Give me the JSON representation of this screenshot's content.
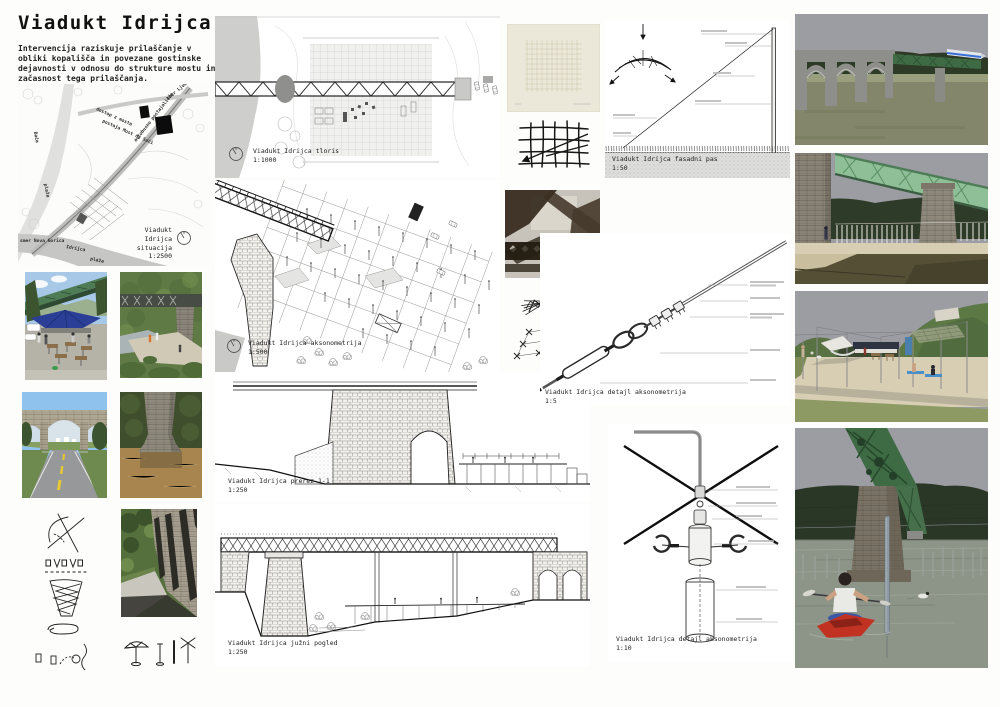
{
  "palette": {
    "truss_green_dark": "#3e6b44",
    "truss_green": "#4e7d55",
    "truss_green_light": "#8fbf96",
    "kayak_red": "#c23222",
    "sky_grey": "#9c9ca3",
    "sky_blue": "#a8c8e8",
    "hill_dark": "#2d3a26",
    "hill_green": "#5b7845",
    "sand": "#d7ceb4",
    "water_grey": "#8d9488",
    "mud_brown": "#a8854e",
    "umbrella_blue": "#2b3f96",
    "towel_blue": "#4a90c8",
    "paper_cream": "#ece8d9"
  },
  "header": {
    "title": "Viadukt Idrijca",
    "intro": "Intervencija raziskuje prilaščanje v obliki kopališča in povezane gostinske dejavnosti v odnosu do strukture mostu in začasnost tega prilaščanja."
  },
  "site_plan": {
    "label": "Viadukt Idrijca\nsituacija\n1:2500",
    "ann_access": "dostop z mosta",
    "ann_station": "postaja Most na Soči",
    "ann_bus": "avtobusno postajališče",
    "ann_beach": "plaža",
    "ann_beach2": "plaža",
    "ann_river_baca": "Bača",
    "ann_river_idrijca": "Idrijca",
    "ann_dir_ng": "smer Nova Gorica",
    "ann_dir_lj": "smer Ljubljana"
  },
  "labels": {
    "tloris": "Viadukt Idrijca tloris\n1:1000",
    "aksonometrija": "Viadukt Idrijca aksonometrija\n1:500",
    "prerez": "Viadukt Idrijca prerez 1-1\n1:250",
    "pogled": "Viadukt Idrijca južni pogled\n1:250",
    "fasadni_pas": "Viadukt Idrijca fasadni pas\n1:50",
    "detajl_5": "Viadukt Idrijca detajl aksonometrija\n1:5",
    "detajl_10": "Viadukt Idrijca detajl aksonometrija\n1:10"
  }
}
